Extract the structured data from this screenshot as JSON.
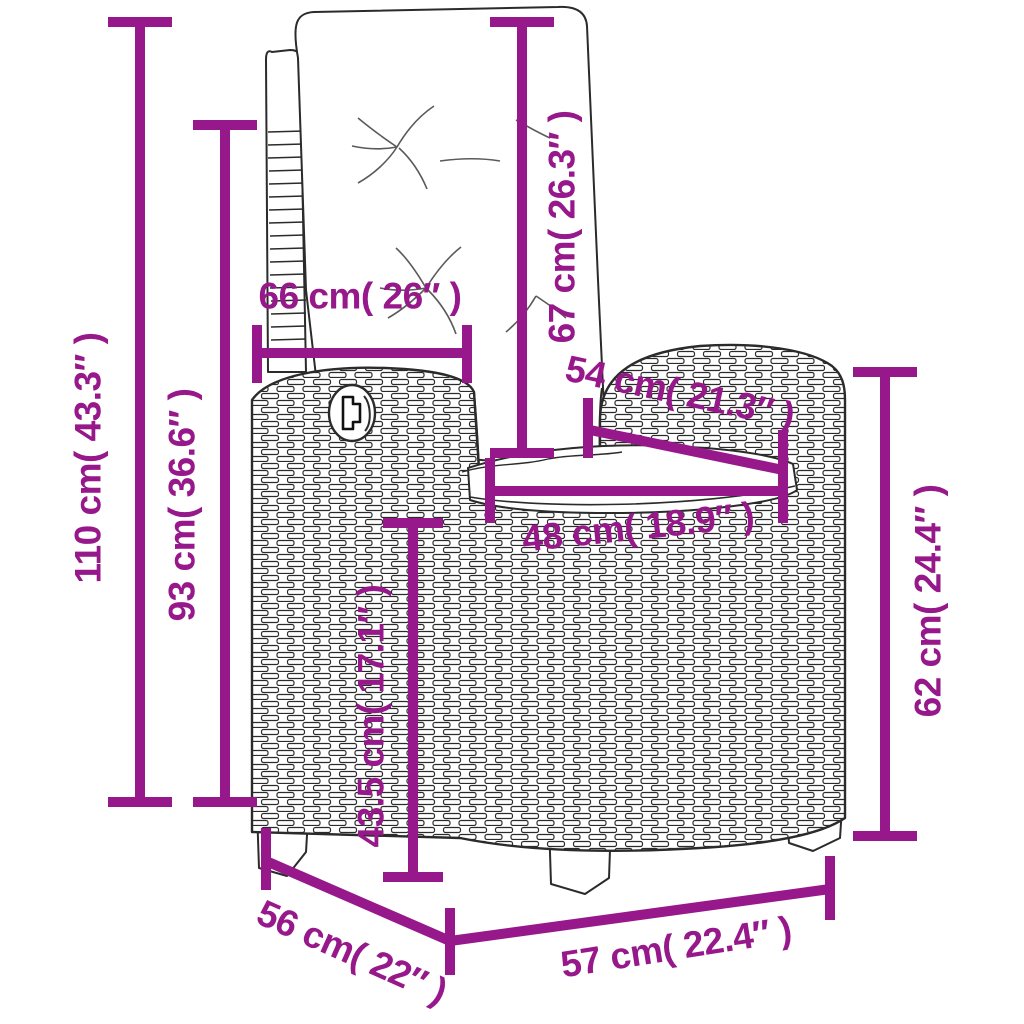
{
  "figure": {
    "description": "Line-art dimension diagram of a poly-rattan reclining garden chair with white cushions",
    "style": "black outline drawing with wicker weave texture, magenta dimension lines"
  },
  "colors": {
    "dimension_accent": "#97188A",
    "line_art": "#2b2b2b",
    "background": "#ffffff",
    "cushion": "#ffffff"
  },
  "labels": {
    "d110": "110 cm( 43.3″ )",
    "d93": "93 cm( 36.6″ )",
    "d66": "66 cm( 26″ )",
    "d67": "67 cm( 26.3″ )",
    "d54": "54 cm( 21.3″ )",
    "d48": "48 cm( 18.9″ )",
    "d43_5": "43.5 cm( 17.1″ )",
    "d62": "62 cm( 24.4″ )",
    "d56": "56 cm( 22″ )",
    "d57": "57 cm( 22.4″ )"
  }
}
